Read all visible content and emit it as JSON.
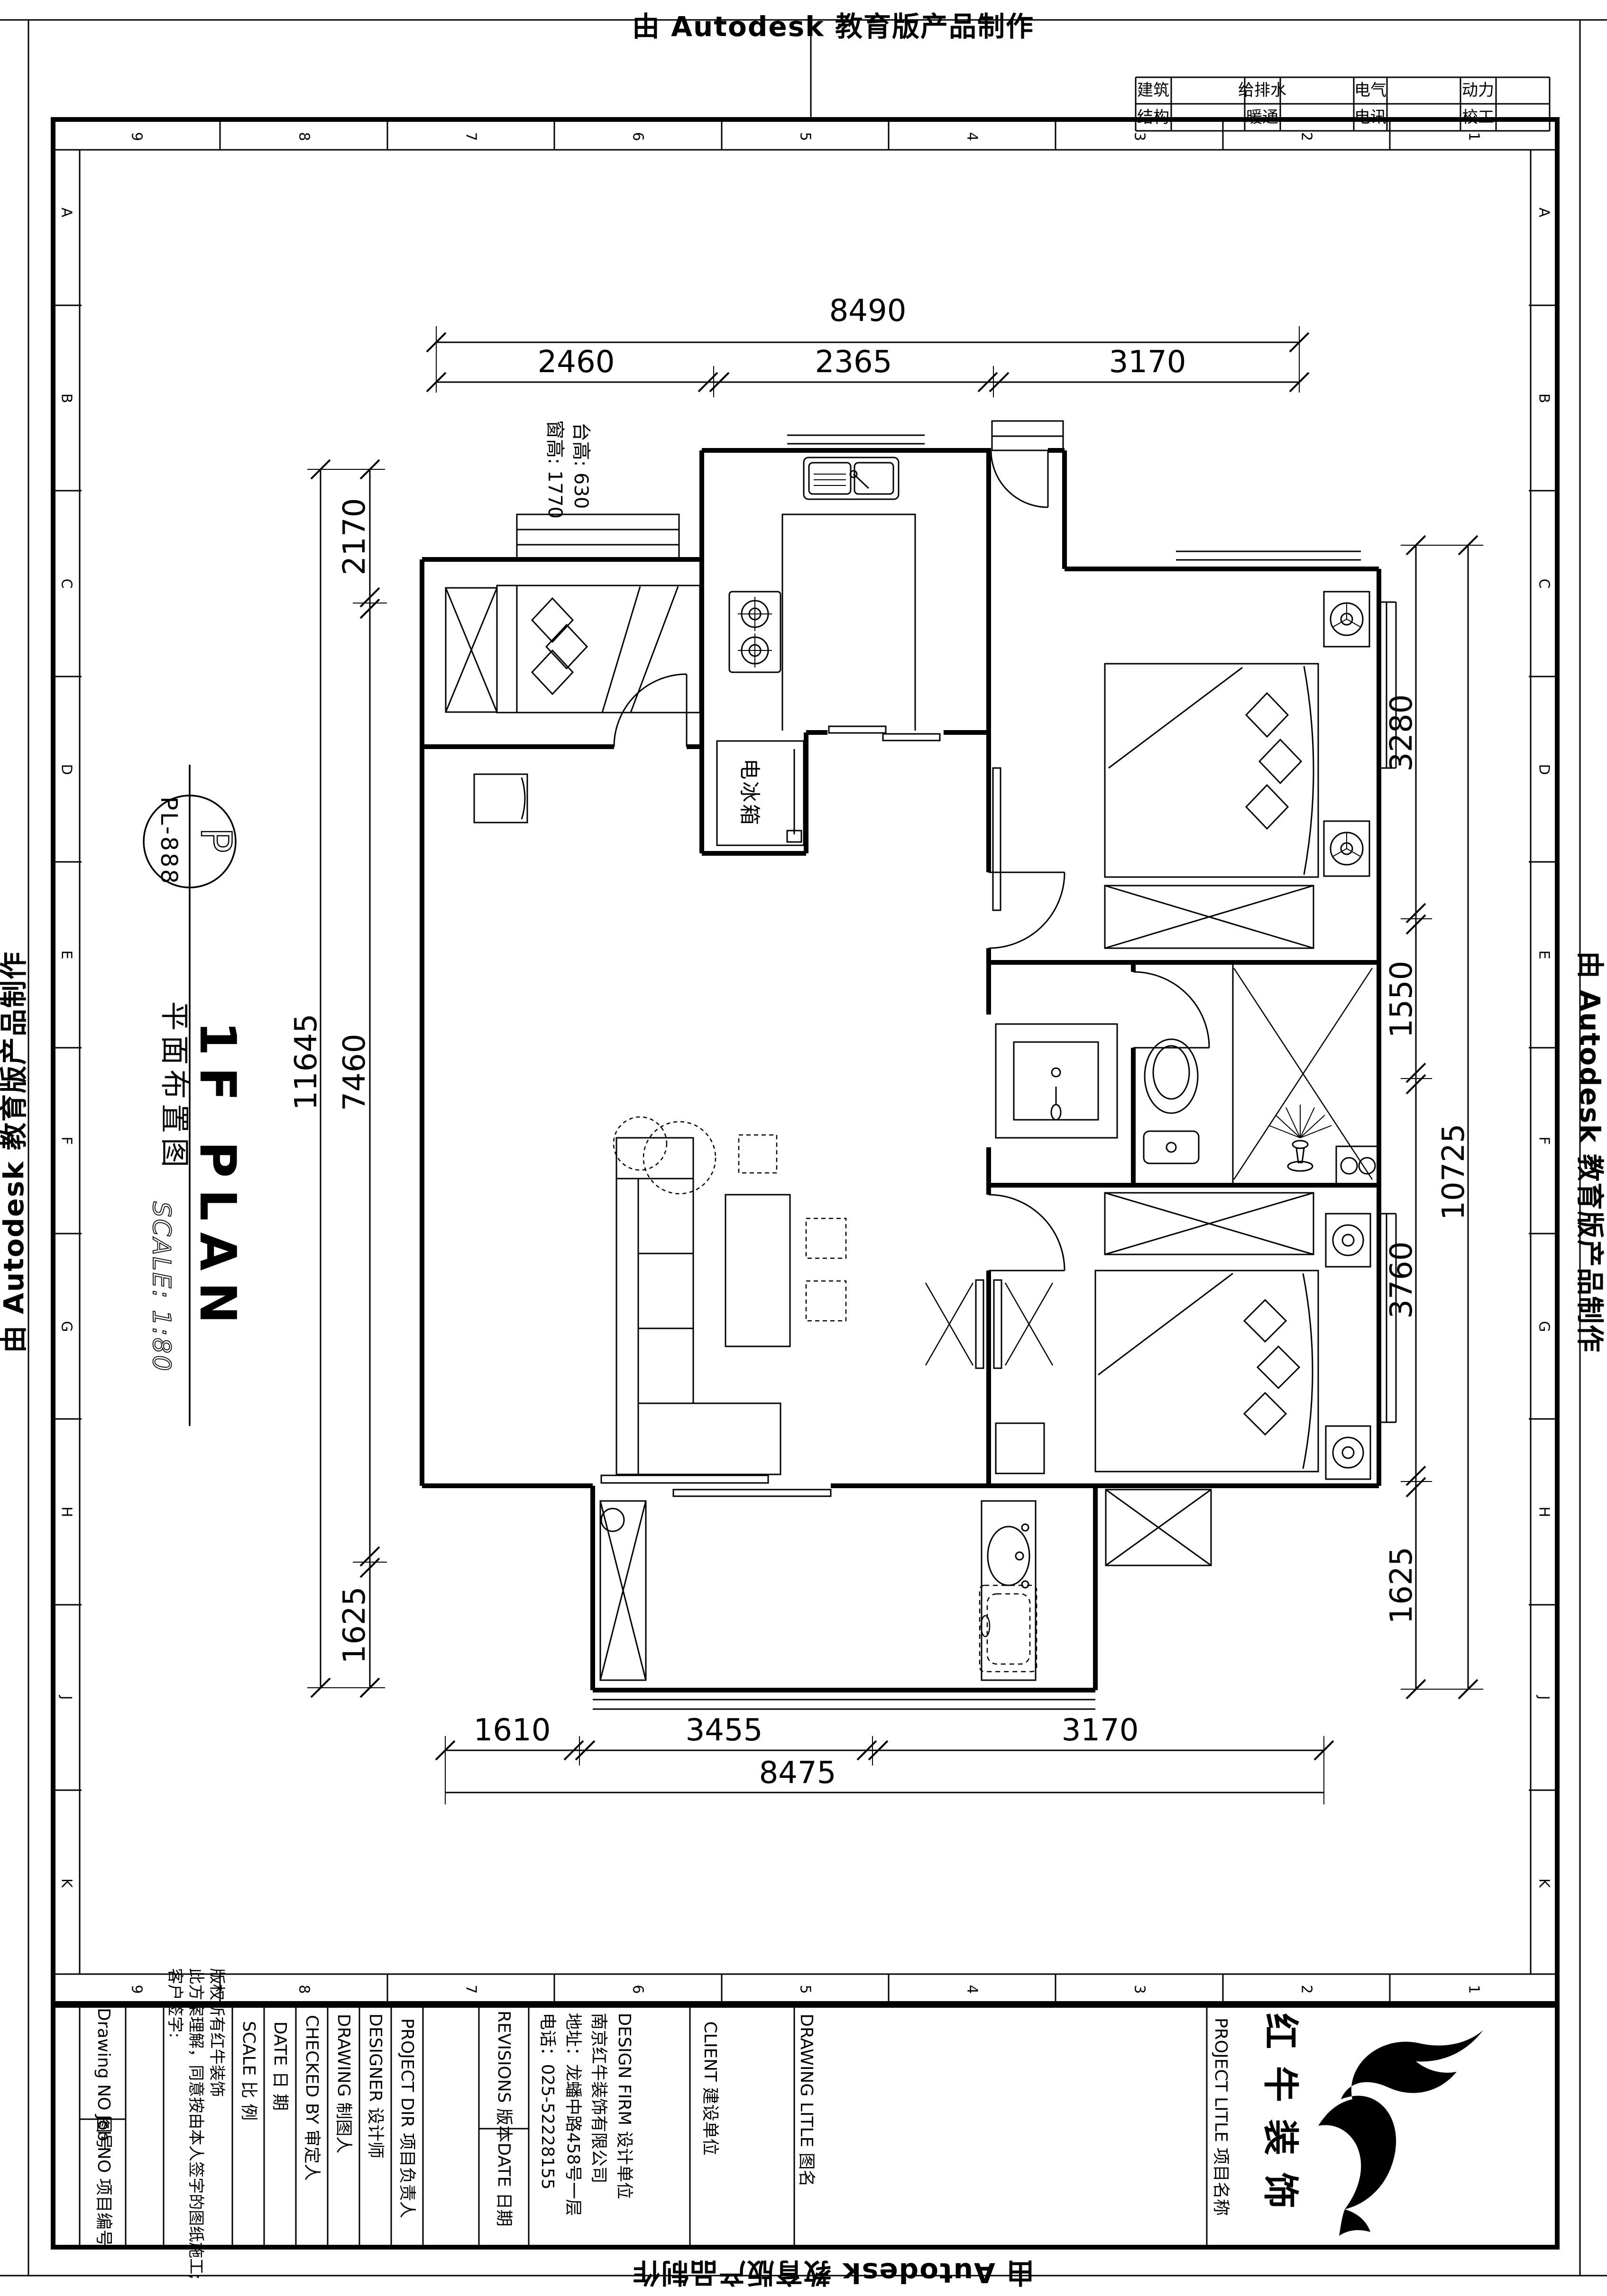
{
  "stamp": {
    "text": "由 Autodesk 教育版产品制作"
  },
  "frame": {
    "top_numbers": [
      "9",
      "8",
      "7",
      "6",
      "5",
      "4",
      "3",
      "2",
      "1"
    ],
    "bottom_numbers": [
      "9",
      "8",
      "7",
      "6",
      "5",
      "4",
      "3",
      "2",
      "1"
    ],
    "left_letters": [
      "A",
      "B",
      "C",
      "D",
      "E",
      "F",
      "G",
      "H",
      "J",
      "K"
    ],
    "right_letters": [
      "A",
      "B",
      "C",
      "D",
      "E",
      "F",
      "G",
      "H",
      "J",
      "K"
    ]
  },
  "discipline_table": {
    "row1": [
      "建筑",
      "给排水",
      "电气",
      "动力"
    ],
    "row2": [
      "结构",
      "暖通",
      "电讯",
      "校工"
    ]
  },
  "symbol": {
    "code": "PL-888",
    "letter": "P"
  },
  "titles": {
    "cn": "平面布置图",
    "en": "1F PLAN",
    "scale": "SCALE: 1:80"
  },
  "notes": {
    "counter": "台高: 630",
    "window": "窗高: 1770",
    "fridge": "电冰箱"
  },
  "dimensions": {
    "top": {
      "total": "8490",
      "segs": [
        "2460",
        "2365",
        "3170"
      ]
    },
    "bottom": {
      "total": "8475",
      "segs": [
        "1610",
        "3455",
        "3170"
      ]
    },
    "left": {
      "total": "11645",
      "segs": [
        "2170",
        "7460",
        "1625"
      ]
    },
    "right": {
      "total": "10725",
      "segs": [
        "3280",
        "1550",
        "3760",
        "1625"
      ]
    }
  },
  "title_block": {
    "drawing_no": "Drawing NO 图号",
    "job_no": "Job NO 项目编号",
    "copyright": [
      "版权所有红牛装饰",
      "此方案理解，同意按由本人签字的图纸施工;",
      "客户签字:"
    ],
    "scale": "SCALE  比 例",
    "date": "DATE  日 期",
    "checked": "CHECKED BY  审定人",
    "drawing": "DRAWING  制图人",
    "designer": "DESIGNER  设计师",
    "project_dir": "PROJECT DIR  项目负责人",
    "revisions": "REVISIONS  版本",
    "rev_date": "DATE  日期",
    "design_firm": "DESIGN FIRM  设计单位",
    "firm_name": "南京红牛装饰有限公司",
    "firm_addr": "地址：龙蟠中路458号一层",
    "firm_tel": "电话：025-52228155",
    "client": "CLIENT  建设单位",
    "drawing_title": "DRAWING LITLE  图名",
    "project_title": "PROJECT LITLE  项目名称",
    "logo_text": "红牛装饰"
  },
  "colors": {
    "ink": "#000000",
    "paper": "#ffffff"
  }
}
